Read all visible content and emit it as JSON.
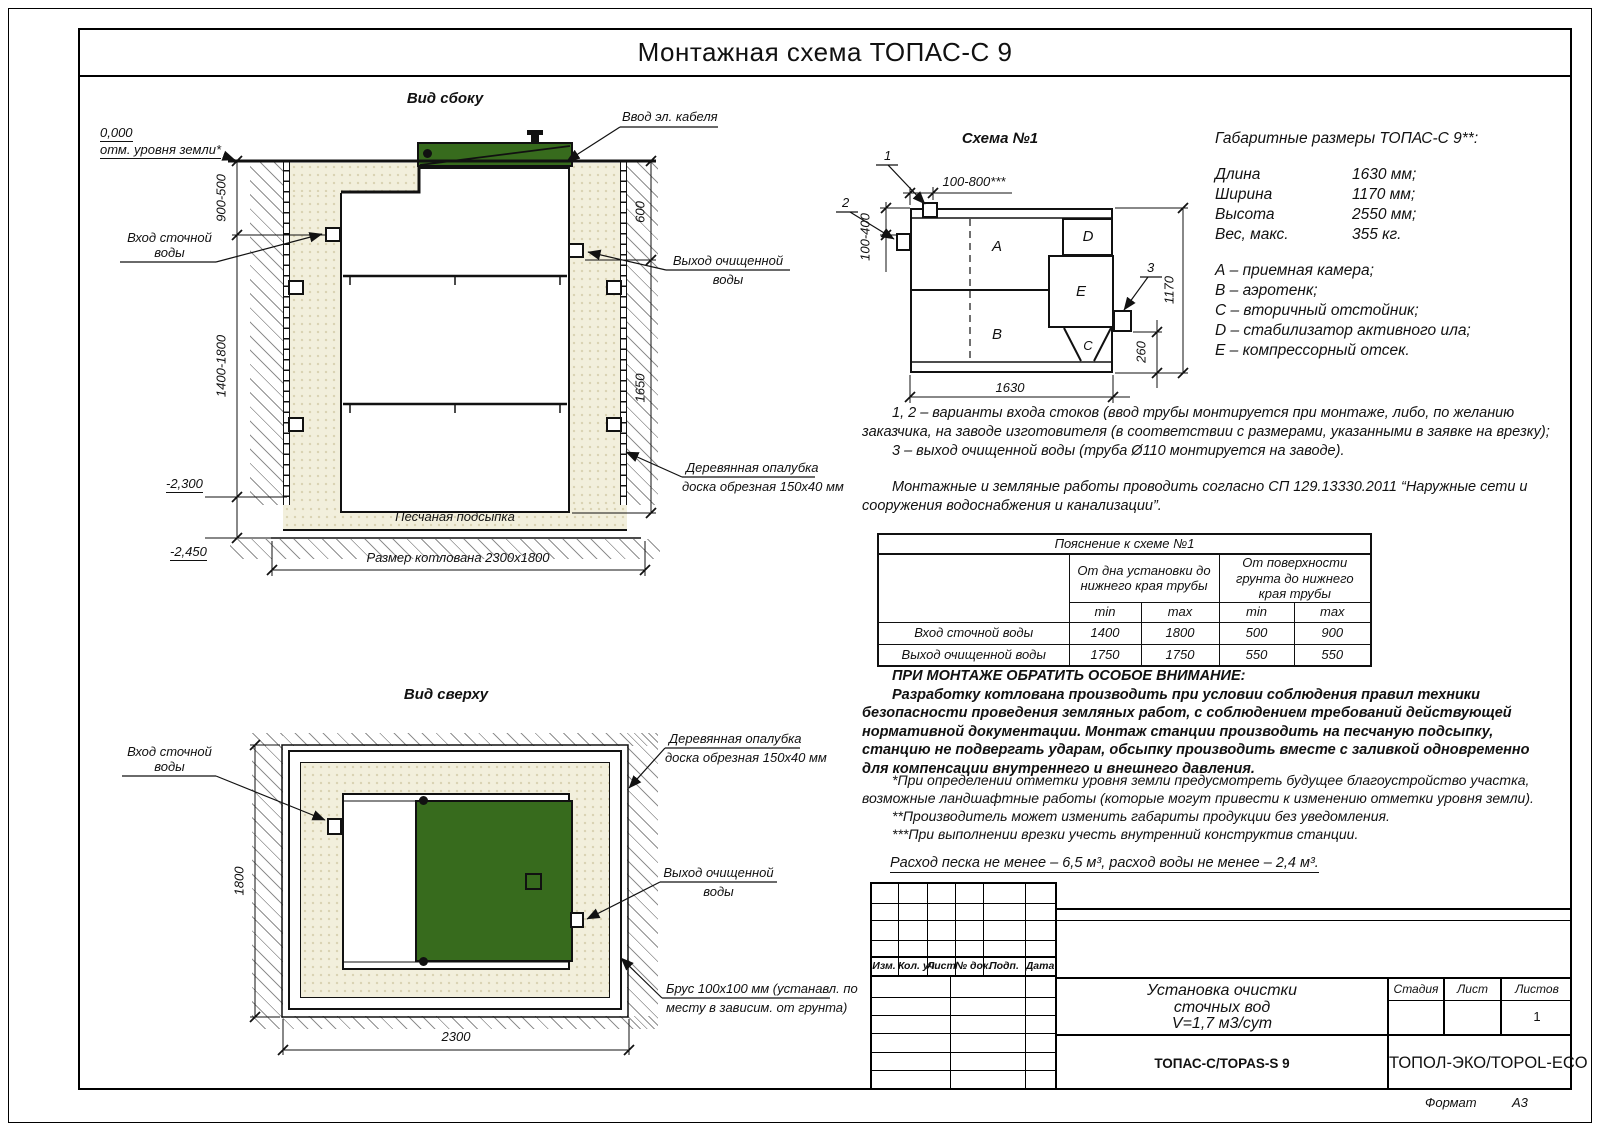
{
  "doc": {
    "title": "Монтажная схема ТОПАС-С 9",
    "format_label": "Формат",
    "format_value": "А3"
  },
  "colors": {
    "green": "#376b1d",
    "sand": "#f2efdc"
  },
  "side_view": {
    "title": "Вид сбоку",
    "elev_zero": "0,000",
    "ground_mark": "отм. уровня земли*",
    "dim_upper": "900-500",
    "dim_lower": "1400-1800",
    "elev_a": "-2,300",
    "elev_b": "-2,450",
    "inlet_l1": "Вход сточной",
    "inlet_l2": "воды",
    "cable": "Ввод эл. кабеля",
    "outlet_l1": "Выход очищенной",
    "outlet_l2": "воды",
    "dim_right_upper": "600",
    "dim_right_lower": "1650",
    "formwork_l1": "Деревянная опалубка",
    "formwork_l2": "доска обрезная 150х40 мм",
    "sand_label": "Песчаная подсыпка",
    "pit_dim": "Размер котлована 2300х1800"
  },
  "top_view": {
    "title": "Вид сверху",
    "inlet_l1": "Вход сточной",
    "inlet_l2": "воды",
    "formwork_l1": "Деревянная опалубка",
    "formwork_l2": "доска обрезная 150х40 мм",
    "outlet_l1": "Выход очищенной",
    "outlet_l2": "воды",
    "beam_l1": "Брус 100х100 мм (устанавл. по",
    "beam_l2": "месту в зависим. от грунта)",
    "dim_height": "1800",
    "dim_width": "2300"
  },
  "schema": {
    "title": "Схема №1",
    "callout_1": "1",
    "callout_2": "2",
    "callout_3": "3",
    "comp_a": "A",
    "comp_b": "B",
    "comp_c": "C",
    "comp_d": "D",
    "comp_e": "E",
    "dim_top": "100-800***",
    "dim_left": "100-400",
    "dim_right": "1170",
    "dim_outlet": "260",
    "dim_bottom": "1630"
  },
  "specs": {
    "heading": "Габаритные размеры ТОПАС-С 9**:",
    "rows": [
      {
        "label": "Длина",
        "value": "1630 мм;"
      },
      {
        "label": "Ширина",
        "value": "1170 мм;"
      },
      {
        "label": "Высота",
        "value": "2550 мм;"
      },
      {
        "label": "Вес, макс.",
        "value": "355 кг."
      }
    ],
    "legend": [
      "А – приемная камера;",
      "В – аэротенк;",
      "С – вторичный отстойник;",
      "D – стабилизатор активного ила;",
      "Е – компрессорный отсек."
    ]
  },
  "notes": {
    "variants_a": "1, 2 – варианты входа  стоков (ввод трубы монтируется при монтаже, либо, по желанию заказчика, на заводе изготовителя (в соответствии с размерами, указанными в заявке на врезку);",
    "variants_b": "3 – выход очищенной воды (труба Ø110 монтируется на заводе).",
    "sp": "Монтажные и земляные работы проводить согласно СП 129.13330.2011 “Наружные сети и сооружения водоснабжения и канализации”."
  },
  "table": {
    "title": "Пояснение к схеме №1",
    "group_1": "От дна установки до нижнего края трубы",
    "group_2": "От поверхности грунта до нижнего края трубы",
    "min": "min",
    "max": "max",
    "rows": [
      {
        "label": "Вход сточной воды",
        "v": [
          "1400",
          "1800",
          "500",
          "900"
        ]
      },
      {
        "label": "Выход очищенной воды",
        "v": [
          "1750",
          "1750",
          "550",
          "550"
        ]
      }
    ]
  },
  "attention": {
    "heading": "ПРИ МОНТАЖЕ ОБРАТИТЬ ОСОБОЕ ВНИМАНИЕ:",
    "body": "Разработку котлована производить при условии соблюдения правил техники безопасности проведения земляных работ, с соблюдением требований действующей нормативной документации. Монтаж станции производить на песчаную подсыпку, станцию не подвергать ударам, обсыпку производить вместе с заливкой одновременно для компенсации внутреннего и внешнего давления."
  },
  "footnotes": {
    "f1": "*При определении отметки уровня земли предусмотреть будущее благоустройство участка, возможные ландшафтные работы (которые могут привести к изменению отметки уровня земли).",
    "f2": "**Производитель может изменить габариты продукции без уведомления.",
    "f3": "***При выполнении врезки учесть внутренний конструктив станции.",
    "consumption": "Расход песка не менее – 6,5 м³, расход воды не менее – 2,4 м³."
  },
  "title_block": {
    "cols": [
      "Изм.",
      "Кол. уч.",
      "Лист",
      "№ док.",
      "Подп.",
      "Дата"
    ],
    "doc_l1": "Установка очистки",
    "doc_l2": "сточных вод",
    "doc_l3": "V=1,7 м3/сут",
    "stage": "Стадия",
    "sheet": "Лист",
    "sheets": "Листов",
    "sheets_value": "1",
    "model": "ТОПАС-С/TOPAS-S 9",
    "company": "ТОПОЛ-ЭКО/TOPOL-ECO"
  }
}
